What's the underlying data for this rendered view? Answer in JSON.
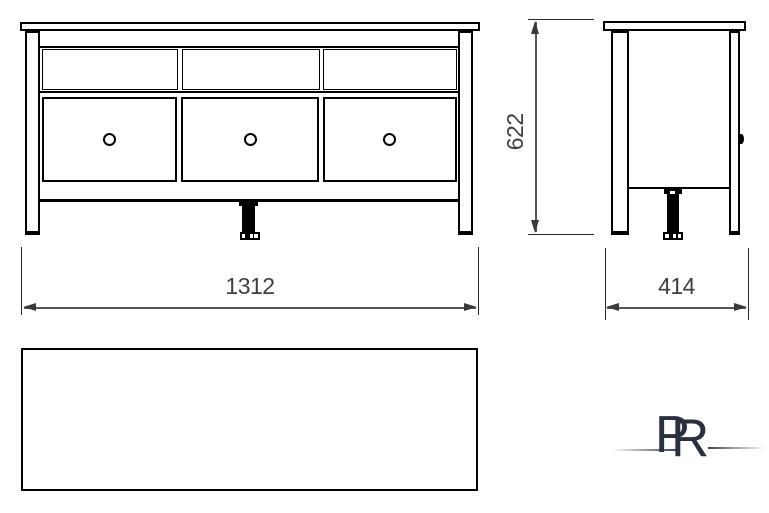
{
  "drawing": {
    "type": "furniture-dimension-drawing",
    "views": [
      "front",
      "side",
      "top"
    ],
    "front_view": {
      "drawer_count": 3,
      "shelf_compartment_count": 3
    },
    "dims": {
      "width": "1312",
      "height": "622",
      "depth": "414"
    }
  },
  "logo": {
    "letter_p": "P",
    "letter_r": "R",
    "color": "#2b3040"
  },
  "colors": {
    "outline": "#000000",
    "dim_line": "#565656",
    "dim_text": "#3f3f3f",
    "background": "#ffffff"
  }
}
